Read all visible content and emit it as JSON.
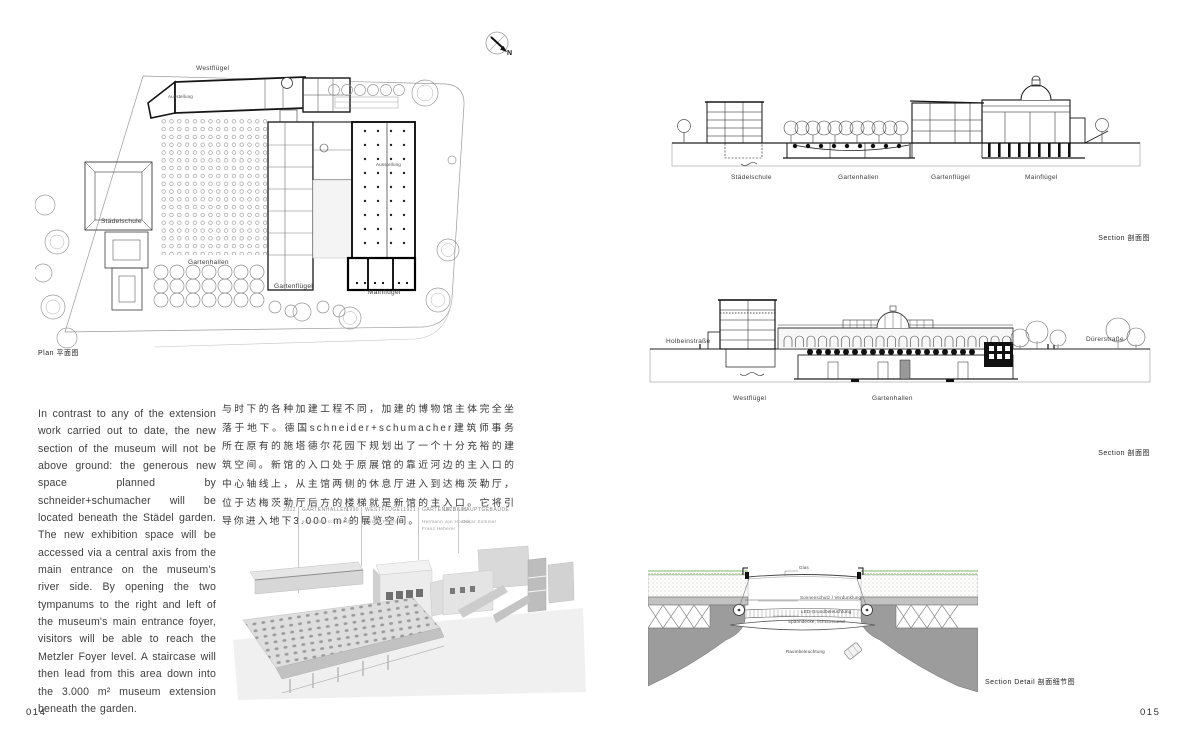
{
  "meta": {
    "page_left": "014",
    "page_right": "015"
  },
  "plan": {
    "caption": "Plan  平面图",
    "north_label": "N",
    "labels": {
      "westfluegel": "Westflügel",
      "ausstellung": "Ausstellung",
      "staedelschule": "Städelschule",
      "gartenhallen": "Gartenhallen",
      "gartenfluegel": "Gartenflügel",
      "mainfluegel": "Mainflügel"
    }
  },
  "body_text": {
    "english": "In contrast to any of the extension work carried out to date, the new section of the museum will not be above ground: the generous new space planned by schneider+schumacher will be located beneath the Städel garden. The new exhibition space will be accessed via a central axis from the main entrance on the museum's river side. By opening the two tympanums to the right and left of the museum's main entrance foyer, visitors will be able to reach the Metzler Foyer level. A staircase will then lead from this area down into the 3.000 m² museum extension beneath the garden.",
    "chinese": "与时下的各种加建工程不同，加建的博物馆主体完全坐落于地下。德国schneider+schumacher建筑师事务所在原有的施塔德尔花园下规划出了一个十分充裕的建筑空间。新馆的入口处于原展馆的靠近河边的主入口的中心轴线上，从主馆两侧的休息厅进入到达梅茨勒厅，位于达梅茨勒厅后方的楼梯就是新馆的主入口。它将引导你进入地下3.000 m²的展览空间。"
  },
  "axonometric": {
    "timeline": [
      {
        "year": "2012",
        "building": "GARTENHALLEN",
        "architect": "schneider+schumacher"
      },
      {
        "year": "1990",
        "building": "WESTFLÜGEL",
        "architect": "Gustav Peichl"
      },
      {
        "year": "1921",
        "building": "GARTENFLÜGEL",
        "architect": "Hermann von Hoven, Franz Heberer"
      },
      {
        "year": "1878",
        "building": "HAUPTGEBÄUDE",
        "architect": "Oskar Sommer"
      }
    ]
  },
  "sections": {
    "section1": {
      "labels": [
        "Städelschule",
        "Gartenhallen",
        "Gartenflügel",
        "Mainflügel"
      ],
      "caption": "Section  剖面图"
    },
    "section2": {
      "street_left": "Holbeinstraße",
      "street_right": "Dürerstraße",
      "labels": [
        "Westflügel",
        "Gartenhallen"
      ],
      "caption": "Section  剖面图"
    },
    "detail": {
      "caption": "Section Detail  剖面细节图",
      "labels": {
        "glass": "Glas",
        "shading": "Sonnenschutz / Verdunklung",
        "base_light": "LED-Grundbeleuchtung",
        "membrane": "Spanndecke, lichtstreuend",
        "room_light": "Raumbeleuchtung"
      }
    }
  },
  "colors": {
    "grass": "#5f9c3e",
    "concrete": "#9c9c9c",
    "light_gray": "#e3e3e3",
    "line": "#1a1a1a"
  }
}
